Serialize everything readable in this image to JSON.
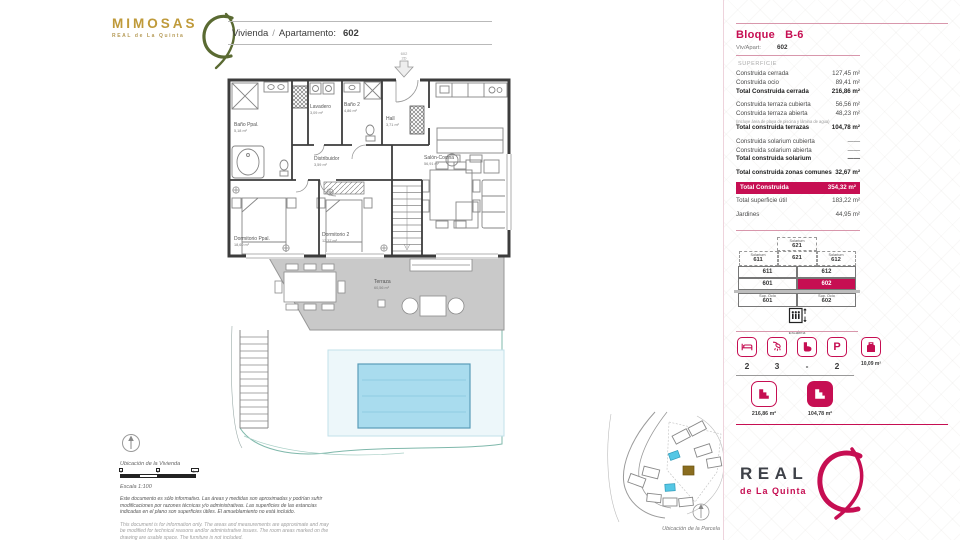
{
  "colors": {
    "accent": "#c60e52",
    "pink_rule": "#d897ac",
    "gold": "#bf9a3a",
    "logo_green": "#5a6a32",
    "terrace_gray": "#c9c9c9",
    "pool_blue": "#a9dcee"
  },
  "brand": {
    "name": "MIMOSAS",
    "subtitle": "REAL de La Quinta"
  },
  "header": {
    "label": "Vivienda",
    "separator": "/",
    "label2": "Apartamento:",
    "value": "602"
  },
  "plan": {
    "entrance_unit": "602",
    "entrance_floor": "2D",
    "rooms": [
      {
        "name": "Baño Ppal.",
        "area": "5,18 m²"
      },
      {
        "name": "Lavadero",
        "area": "3,09 m²"
      },
      {
        "name": "Baño 2",
        "area": "4,86 m²"
      },
      {
        "name": "Hall",
        "area": "3,71 m²"
      },
      {
        "name": "Distribuidor",
        "area": "3,59 m²"
      },
      {
        "name": "Salón-Cocina",
        "area": "56,91 m²"
      },
      {
        "name": "Dormitorio Ppal.",
        "area": "18,60 m²"
      },
      {
        "name": "Dormitorio 2",
        "area": "12,37 m²"
      },
      {
        "name": "Terraza",
        "area": "60,56 m²"
      }
    ]
  },
  "sidebar": {
    "block_label": "Bloque",
    "block_value": "B-6",
    "unit_label": "Viv/Apart:",
    "unit_value": "602",
    "surface_title": "SUPERFICIE",
    "surface_rows": [
      {
        "label": "Construida cerrada",
        "value": "127,45 m²",
        "style": "normal",
        "gap_before": false
      },
      {
        "label": "Construida ocio",
        "value": "89,41 m²",
        "style": "normal",
        "gap_before": false
      },
      {
        "label": "Total Construida cerrada",
        "value": "216,86 m²",
        "style": "bold",
        "gap_before": false
      },
      {
        "label": "Construida terraza cubierta",
        "value": "56,56 m²",
        "style": "normal",
        "gap_before": true
      },
      {
        "label": "Construida terraza abierta",
        "value": "48,23 m²",
        "style": "normal",
        "gap_before": false
      },
      {
        "label": "(Incluye área de playa de piscina y lámina de agua)",
        "value": "",
        "style": "note",
        "gap_before": false
      },
      {
        "label": "Total construida terrazas",
        "value": "104,78 m²",
        "style": "bold",
        "gap_before": false
      },
      {
        "label": "Construida solarium cubierta",
        "value": "——",
        "style": "normal",
        "gap_before": true
      },
      {
        "label": "Construida solarium abierta",
        "value": "——",
        "style": "normal",
        "gap_before": false
      },
      {
        "label": "Total construida solarium",
        "value": "——",
        "style": "bold",
        "gap_before": false
      },
      {
        "label": "Total construida zonas comunes",
        "value": "32,67 m²",
        "style": "bold",
        "gap_before": true
      },
      {
        "label": "Total Construida",
        "value": "354,32 m²",
        "style": "highlight",
        "gap_before": false
      },
      {
        "label": "Total superficie útil",
        "value": "183,22 m²",
        "style": "normal",
        "gap_before": false
      },
      {
        "label": "Jardines",
        "value": "44,95 m²",
        "style": "normal",
        "gap_before": true
      }
    ],
    "stack": {
      "top": {
        "label": "Solarium",
        "value": "621"
      },
      "row1": [
        {
          "label": "Solarium",
          "value": "611"
        },
        {
          "label": "",
          "value": "621"
        },
        {
          "label": "Solarium",
          "value": "612"
        }
      ],
      "row2": [
        "611",
        "612"
      ],
      "row3": [
        "601",
        "602"
      ],
      "row4": [
        {
          "label": "Sup. Ocio",
          "value": "601"
        },
        {
          "label": "Sup. Ocio",
          "value": "602"
        }
      ]
    },
    "lift_label": "Escalera",
    "features": [
      {
        "icon": "bed",
        "value": "2"
      },
      {
        "icon": "shower",
        "value": "3"
      },
      {
        "icon": "toilet",
        "value": "-"
      },
      {
        "icon": "parking",
        "glyph": "P",
        "value": "2"
      },
      {
        "icon": "storage",
        "value": "10,09 m²"
      }
    ],
    "area_badges": [
      {
        "icon": "built-area",
        "value": "216,86 m²"
      },
      {
        "icon": "terrace-area",
        "value": "104,78 m²"
      }
    ],
    "logo": {
      "line1": "REAL",
      "line2": "de La Quinta"
    }
  },
  "footnotes": {
    "home_location": "Ubicación de la Vivienda",
    "scale": "Escala 1:100",
    "scale_ticks": [
      "0",
      "2",
      "4m"
    ],
    "disclaimer_es": "Este documento es sólo informativo. Las áreas y medidas son aproximadas y podrían sufrir modificaciones por razones técnicas y/o administrativas. Las superficies de las estancias indicadas en el plano son superficies útiles. El amueblamiento no está incluido.",
    "disclaimer_en": "This document is for information only. The areas and measurements are approximate and may be modified for technical reasons and/or administrative issues. The room areas marked on the drawing are usable space. The furniture is not included.",
    "parcel_location": "Ubicación de la Parcela"
  }
}
